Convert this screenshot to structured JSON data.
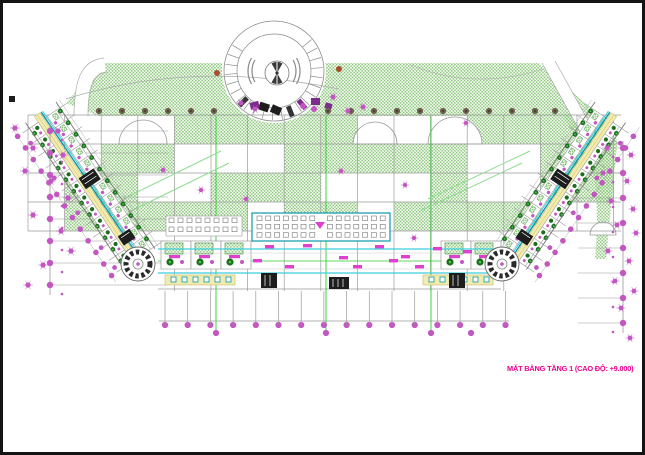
{
  "title": {
    "label": "MẶT BẰNG TẦNG 1 (CAO ĐỘ: +9.000)"
  },
  "colors": {
    "hatch_green": "#82c46f",
    "grid_gray": "#9a9a9a",
    "curb_gray": "#aaaaaa",
    "dim_magenta": "#c257c2",
    "wall_cyan": "#3ecede",
    "teal": "#0b98a8",
    "corridor_yellow": "#f1ebb0",
    "yellow_edge": "#c8b86a",
    "tree_dark": "#1c6e1c",
    "tree_bright": "#49c94f",
    "tree_olive": "#6e604e",
    "accent_green": "#2ecc2e",
    "accent_light": "#8fdc8f",
    "label_magenta": "#e03fd0",
    "title_magenta": "#ea0090",
    "rust": "#a5502f",
    "purple": "#7b2d8b",
    "dark": "#1d1d1d",
    "room_line": "#999999",
    "frame": "#141414"
  }
}
